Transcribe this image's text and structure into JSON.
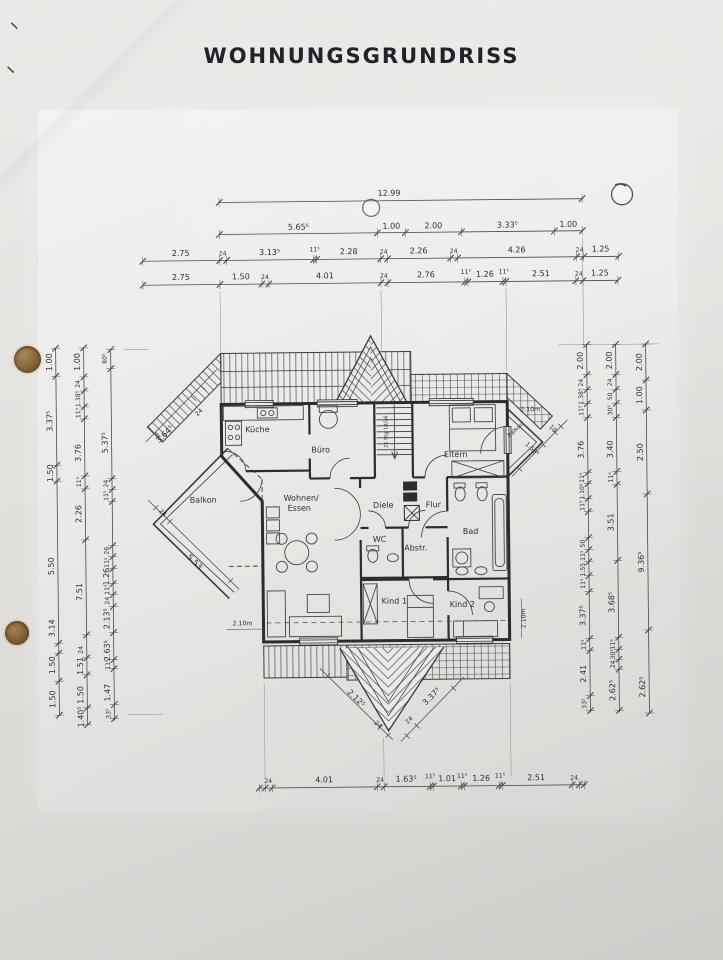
{
  "page": {
    "title": "WOHNUNGSGRUNDRISS"
  },
  "rooms": {
    "kueche": "Küche",
    "buero": "Büro",
    "eltern": "Eltern",
    "balkon_left": "Balkon",
    "balkon_right": "Balkon",
    "wohnen_line1": "Wohnen/",
    "wohnen_line2": "Essen",
    "diele": "Diele",
    "flur": "Flur",
    "wc": "WC",
    "abstr": "Abstr.",
    "bad": "Bad",
    "kind1": "Kind 1",
    "kind2": "Kind 2"
  },
  "annotations": {
    "stairs": "21 Stg 18/26",
    "lintel_left": "2.10m",
    "lintel_right": "2.10m",
    "lintel_balkon": "2.10m"
  },
  "dims": {
    "top_total": "12.99",
    "top_row2": [
      "5.65⁵",
      "1.00",
      "2.00",
      "3.33⁵",
      "1.00"
    ],
    "top_row3": [
      "2.75",
      "24",
      "3.13⁵",
      "11⁵",
      "2.28",
      "24",
      "2.26",
      "24",
      "4.26",
      "24",
      "1.25"
    ],
    "top_row4": [
      "2.75",
      "1.50",
      "24",
      "4.01",
      "24",
      "2.76",
      "11⁵",
      "1.26",
      "11⁵",
      "2.51",
      "24",
      "1.25"
    ],
    "bottom": [
      "24",
      "4.01",
      "24",
      "1.63⁵",
      "11⁵",
      "1.01",
      "11⁵",
      "1.26",
      "11⁵",
      "2.51",
      "24"
    ],
    "left_outer": [
      "1.00",
      "3.37⁵",
      "1.50",
      "5.50",
      "3.14",
      "1.50",
      "1.50"
    ],
    "left_mid": [
      "1.00",
      "24",
      "1.38⁵",
      "11⁵",
      "3.76",
      "11⁵",
      "2.26",
      "7.51",
      "24",
      "1.51",
      "1.50",
      "1.40⁵"
    ],
    "left_inner": [
      "80⁵",
      "5.37⁵",
      "24",
      "11⁵",
      "26",
      "11⁵",
      "1.26",
      "11⁵",
      "24",
      "2.13⁵",
      "2.63⁵",
      "11⁵",
      "1.47",
      "33⁵"
    ],
    "right_inner": [
      "2.00",
      "24",
      "1.38⁵",
      "11⁵",
      "3.76",
      "11⁵",
      "1.10⁵",
      "11⁵",
      "50",
      "11⁵",
      "1.55",
      "11⁵",
      "3.37⁵",
      "11⁵",
      "2.41",
      "33⁵"
    ],
    "right_mid": [
      "2.00",
      "24",
      "50",
      "30⁵",
      "3.40",
      "11⁵",
      "3.51",
      "3.68⁵",
      "11⁵",
      "30⁵",
      "24",
      "2.62⁵"
    ],
    "right_outer": [
      "2.00",
      "1.00",
      "2.50",
      "9.36⁵",
      "2.62⁵"
    ],
    "diag_left_top": [
      "24",
      "3.64⁵"
    ],
    "diag_left_bottom": [
      "24",
      "5.53"
    ],
    "diag_right_balkon": [
      "1.58⁵",
      "10"
    ],
    "diag_bottom_left": [
      "2.12⁵",
      "24"
    ],
    "diag_bottom_right": [
      "24",
      "3.37⁵"
    ]
  }
}
